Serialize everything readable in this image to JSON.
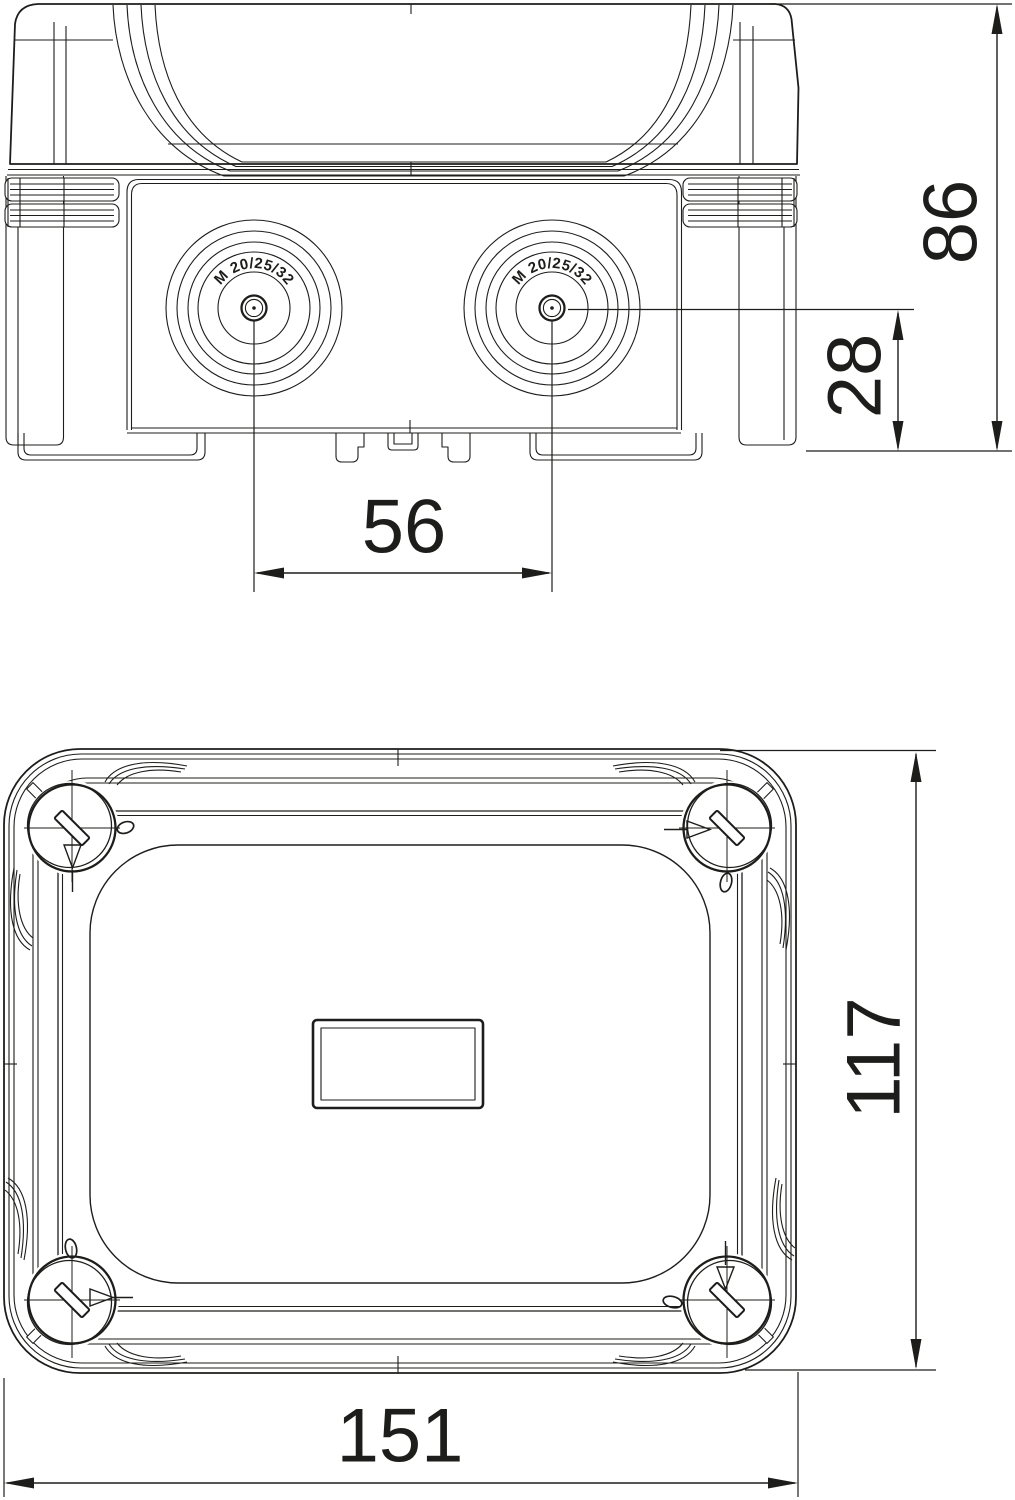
{
  "drawing": {
    "background": "#ffffff",
    "line_color": "#1d1d1b",
    "side_view": {
      "cable_entries": [
        {
          "label": "M 20/25/32"
        },
        {
          "label": "M 20/25/32"
        }
      ],
      "dims": {
        "overall_height": "86",
        "entry_axis_to_bottom": "28",
        "entry_spacing": "56"
      }
    },
    "bottom_view": {
      "dims": {
        "overall_depth": "117",
        "overall_width": "151"
      }
    }
  }
}
